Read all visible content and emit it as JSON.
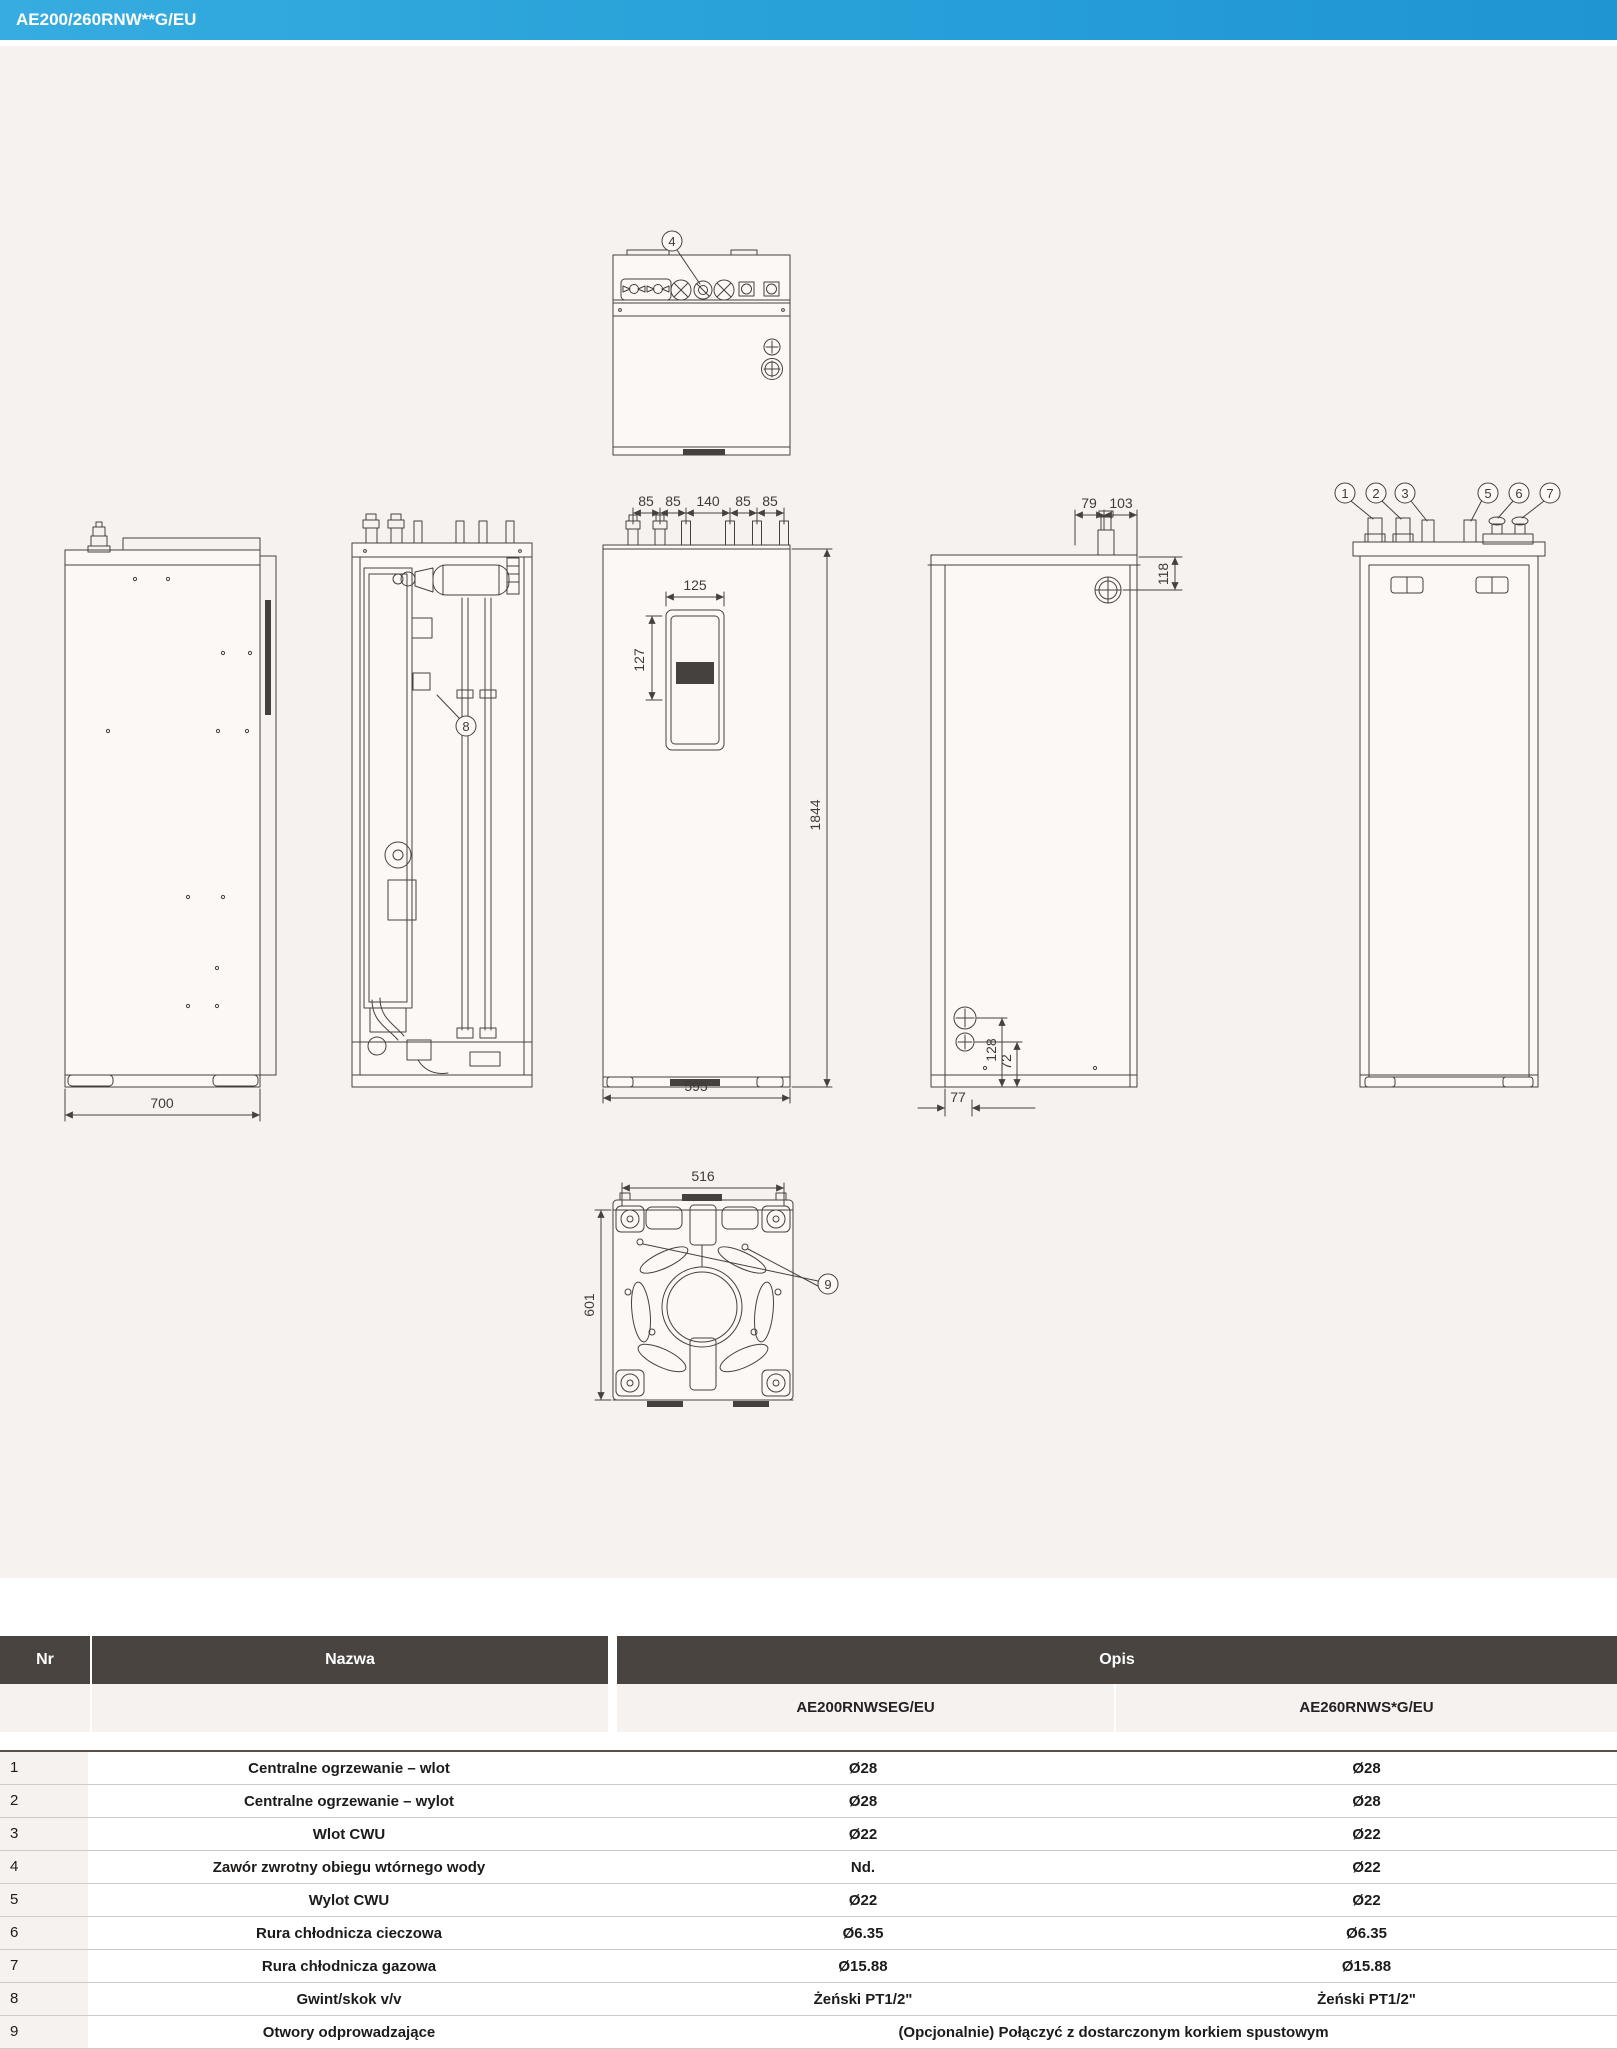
{
  "header": {
    "title": "AE200/260RNW**G/EU"
  },
  "drawing": {
    "callouts": {
      "c4": "4",
      "c8": "8",
      "c9": "9",
      "back": [
        "1",
        "2",
        "3",
        "5",
        "6",
        "7"
      ]
    },
    "dims": {
      "top_pipe_spacing": [
        "85",
        "85",
        "140",
        "85",
        "85"
      ],
      "panel_width": "125",
      "panel_height": "127",
      "unit_height": "1844",
      "front_width": "595",
      "side_depth": "700",
      "side_top_offsets": [
        "79",
        "103"
      ],
      "side_top_height": "118",
      "side_bottom_offsets": [
        "128",
        "72",
        "77"
      ],
      "base_width": "516",
      "base_depth": "601"
    }
  },
  "table": {
    "headers": {
      "nr": "Nr",
      "nazwa": "Nazwa",
      "opis": "Opis"
    },
    "models": [
      "AE200RNWSEG/EU",
      "AE260RNWS*G/EU"
    ],
    "rows": [
      {
        "nr": "1",
        "nazwa": "Centralne ogrzewanie – wlot",
        "v1": "Ø28",
        "v2": "Ø28"
      },
      {
        "nr": "2",
        "nazwa": "Centralne ogrzewanie – wylot",
        "v1": "Ø28",
        "v2": "Ø28"
      },
      {
        "nr": "3",
        "nazwa": "Wlot CWU",
        "v1": "Ø22",
        "v2": "Ø22"
      },
      {
        "nr": "4",
        "nazwa": "Zawór zwrotny obiegu wtórnego wody",
        "v1": "Nd.",
        "v2": "Ø22"
      },
      {
        "nr": "5",
        "nazwa": "Wylot CWU",
        "v1": "Ø22",
        "v2": "Ø22"
      },
      {
        "nr": "6",
        "nazwa": "Rura chłodnicza cieczowa",
        "v1": "Ø6.35",
        "v2": "Ø6.35"
      },
      {
        "nr": "7",
        "nazwa": "Rura chłodnicza gazowa",
        "v1": "Ø15.88",
        "v2": "Ø15.88"
      },
      {
        "nr": "8",
        "nazwa": "Gwint/skok v/v",
        "v1": "Żeński PT1/2\"",
        "v2": "Żeński PT1/2\""
      },
      {
        "nr": "9",
        "nazwa": "Otwory odprowadzające",
        "span": "(Opcjonalnie) Połączyć z dostarczonym korkiem spustowym"
      }
    ]
  }
}
